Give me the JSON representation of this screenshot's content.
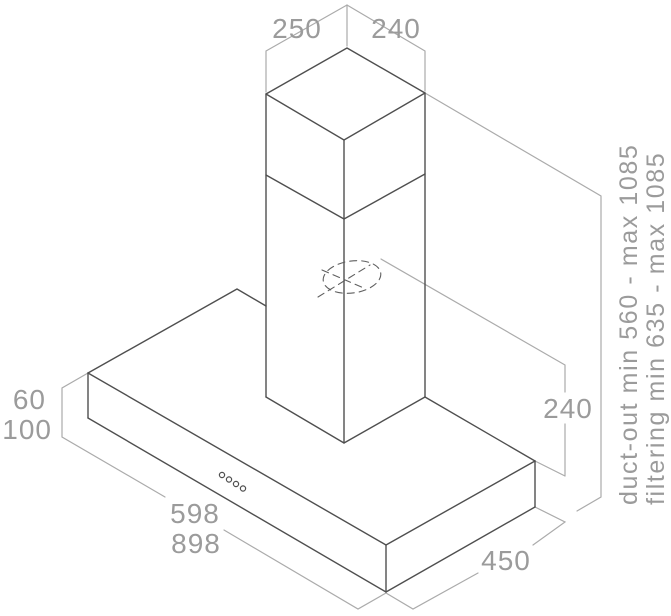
{
  "labels": {
    "chimney_top_depth": "250",
    "chimney_top_width": "240",
    "hood_front_height": "60",
    "hood_total_height": "100",
    "hood_inner_width": "598",
    "hood_overall_width": "898",
    "hood_depth": "450",
    "duct_height": "240",
    "duct_out_range": "duct-out min 560 - max 1085",
    "filtering_range": "filtering min 635 - max 1085"
  },
  "colors": {
    "outline": "#4f4f4f",
    "dimension_lines": "#ababab",
    "label_text": "#9b9b9b",
    "background": "#ffffff"
  }
}
